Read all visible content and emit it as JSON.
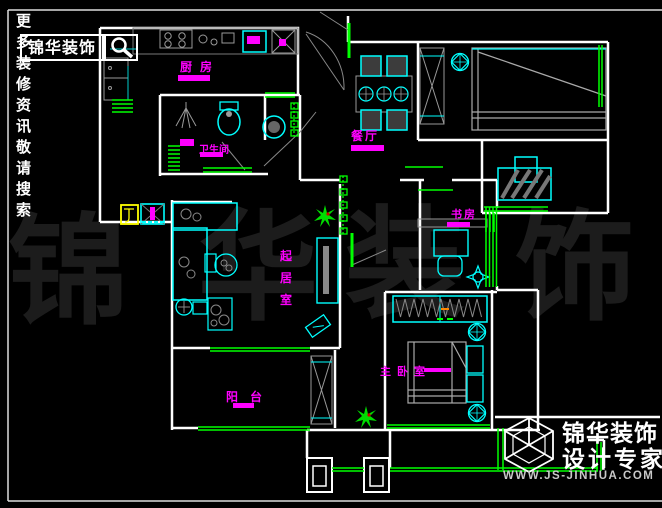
{
  "canvas": {
    "width": 662,
    "height": 508,
    "background": "#000000"
  },
  "palette": {
    "wall": "#ffffff",
    "furniture": "#00ffff",
    "window_door": "#00ff00",
    "room_label": "#ff00ff",
    "fixture_gray": "#999999",
    "equipment_box": "#ffff00",
    "watermark": "#1c1c1c"
  },
  "header": {
    "tagline": "更多装修资讯敬请搜索",
    "search_text": "锦华装饰",
    "search_icon": "magnifier"
  },
  "watermark": {
    "chars": [
      "锦",
      "华",
      "装",
      "饰"
    ]
  },
  "rooms": {
    "kitchen": {
      "label": "厨房"
    },
    "dining": {
      "label": "餐厅"
    },
    "bathroom": {
      "label": "卫生间"
    },
    "study": {
      "label": "书房"
    },
    "living_room": {
      "label": "起居室"
    },
    "master_bedroom": {
      "label": "主卧室"
    },
    "balcony": {
      "label": "阳台"
    }
  },
  "footer_logo": {
    "brand": "锦华装饰",
    "subtitle": "设计专家",
    "website": "WWW.JS-JINHUA.COM",
    "mark_icon": "wireframe-cube"
  }
}
